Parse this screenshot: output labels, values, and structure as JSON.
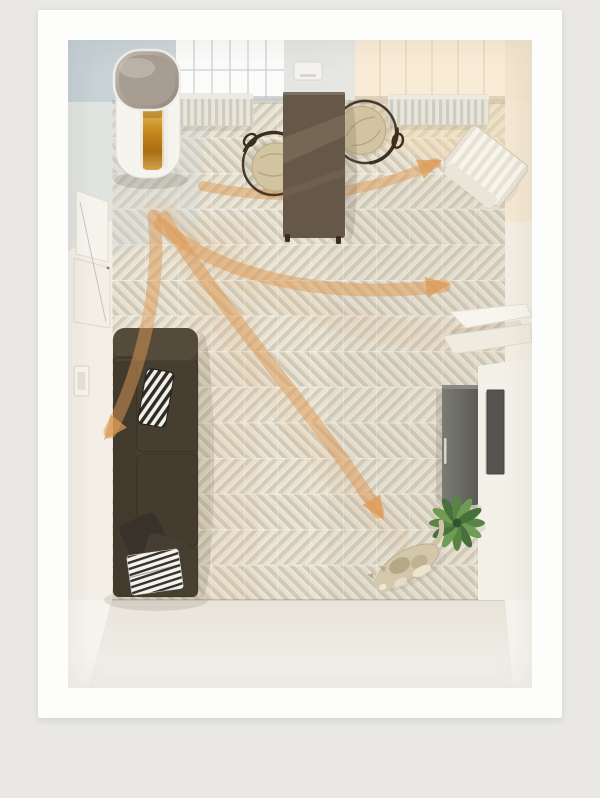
{
  "scene": {
    "title": "top-down-room-airflow-render",
    "colors": {
      "page_bg": "#e9e8e5",
      "frame": "#fdfdfc",
      "wall": "#f2eee6",
      "window_cool": "#fbfbfa",
      "window_warm": "#f8ecd6",
      "floor_light": "#e9e3d3",
      "floor_dark": "#d5cdbb",
      "bottom_floor": "#edebe4",
      "sofa": "#4a4133",
      "table": "#655848",
      "chair_seat": "#d2c3a1",
      "chair_frame": "#3c2f22",
      "cabinet": "#6b6a64",
      "wall_panel": "#55544e",
      "purifier_body": "#f6f4ef",
      "purifier_cap": "#a89d92",
      "purifier_filter": "#c3841b",
      "radiator": "#e8e5db",
      "white_chair": "#e7e2d4",
      "shelf": "#f8f5ef",
      "plant": "#578544",
      "cat": "#d3c7aa",
      "arrow": "#de9a55"
    },
    "objects": [
      {
        "id": "air-purifier",
        "label": "Air purifier with amber filter window"
      },
      {
        "id": "dining-table",
        "label": "Dark wooden dining table"
      },
      {
        "id": "dining-chair-left",
        "label": "Round rattan chair"
      },
      {
        "id": "dining-chair-right",
        "label": "Round rattan chair"
      },
      {
        "id": "window-left",
        "label": "Window with cool daylight"
      },
      {
        "id": "window-right",
        "label": "Window with warm sunlight"
      },
      {
        "id": "wall-vent",
        "label": "Wall-mounted control box"
      },
      {
        "id": "radiator-left",
        "label": "Radiator under left window"
      },
      {
        "id": "radiator-right",
        "label": "Radiator under right window"
      },
      {
        "id": "slatted-chair",
        "label": "White slatted chair in top-right corner"
      },
      {
        "id": "wall-shelf",
        "label": "White zigzag wall shelf"
      },
      {
        "id": "sideboard",
        "label": "Grey sideboard cabinet"
      },
      {
        "id": "wall-panel",
        "label": "Grey panel on right wall"
      },
      {
        "id": "sofa",
        "label": "Dark brown leather sofa"
      },
      {
        "id": "striped-pillow",
        "label": "Black and white striped pillow"
      },
      {
        "id": "throw-pillows",
        "label": "Dark throw pillows"
      },
      {
        "id": "striped-blanket",
        "label": "Striped folded blanket"
      },
      {
        "id": "leaning-frames",
        "label": "Frames leaning against left wall"
      },
      {
        "id": "light-switch",
        "label": "Light switch on left wall"
      },
      {
        "id": "potted-plant",
        "label": "Green plant seen from above"
      },
      {
        "id": "cat",
        "label": "Cat lying on the floor"
      },
      {
        "id": "herringbone-floor",
        "label": "Herringbone parquet floor"
      }
    ],
    "airflow_arrows": [
      {
        "name": "to-dining-corner",
        "shaft": "M135,146 Q260,172 368,123",
        "head_transform": "translate(374,120) rotate(-23)"
      },
      {
        "name": "to-right-wall",
        "shaft": "M92,184 C160,244 272,258 376,246",
        "head_transform": "translate(382,244) rotate(-8)"
      },
      {
        "name": "to-floor-center",
        "shaft": "M96,178 C152,268 258,388 310,472",
        "head_transform": "translate(316,480) rotate(58)"
      },
      {
        "name": "to-sofa-corner",
        "shaft": "M86,176 C94,242 74,330 42,392",
        "head_transform": "translate(36,400) rotate(128)"
      }
    ],
    "arrow_head_shape": "M0 0 L-24 10.5 L-24 -10.5 Z"
  }
}
